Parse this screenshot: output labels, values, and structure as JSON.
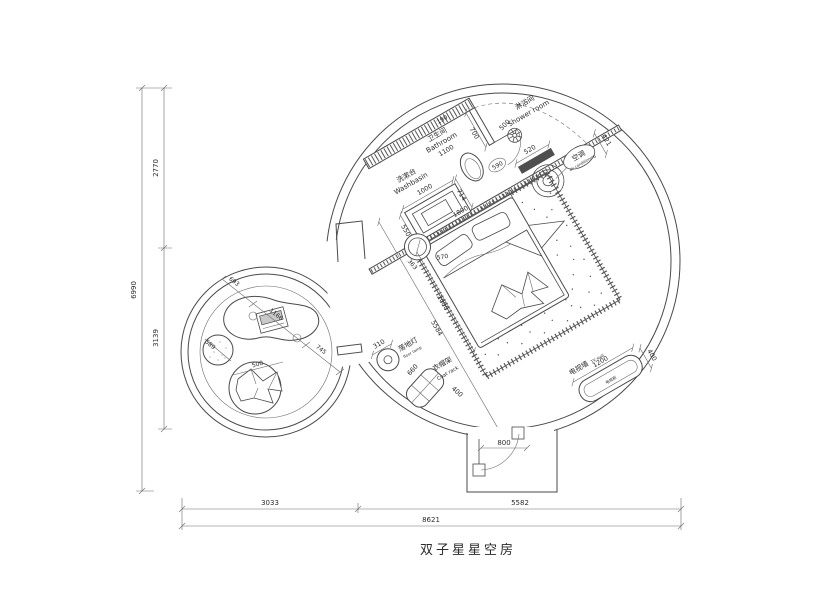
{
  "title": "双子星星空房",
  "labels": {
    "washbasin_cn": "洗漱台",
    "washbasin_en": "Washbasin",
    "bathroom_cn": "卫生间",
    "bathroom_en": "Bathroom",
    "shower_cn": "淋浴间",
    "shower_en": "Shower room",
    "ac_cn": "空调",
    "ac_en": "air conditioning",
    "lamp_cn": "落地灯",
    "lamp_en": "floor lamp",
    "rack_cn": "衣帽架",
    "rack_en": "Coat rack",
    "tv_wall_cn": "电视墙",
    "tv_wall_en": "TV wall",
    "tv_cabinet_cn": "电视柜"
  },
  "dims": {
    "d190": "190",
    "d700": "700",
    "d500_shower": "500",
    "d590": "590",
    "d520": "520",
    "d421": "421",
    "d1100": "1100",
    "d1000": "1000",
    "d550": "550",
    "d714": "714",
    "d1800": "1800",
    "d363": "363",
    "d570": "570",
    "d2000": "2000",
    "d5584": "5584",
    "d310": "310",
    "d660": "660",
    "d400_rack": "400",
    "d1200": "1200",
    "d400_tv": "400",
    "d800": "800",
    "d693": "693",
    "d1166": "1166",
    "d745": "745",
    "d589": "589",
    "d500_chair": "500",
    "d2770": "2770",
    "d3139": "3139",
    "d6990": "6990",
    "d3033": "3033",
    "d5582": "5582",
    "d8621": "8621"
  }
}
